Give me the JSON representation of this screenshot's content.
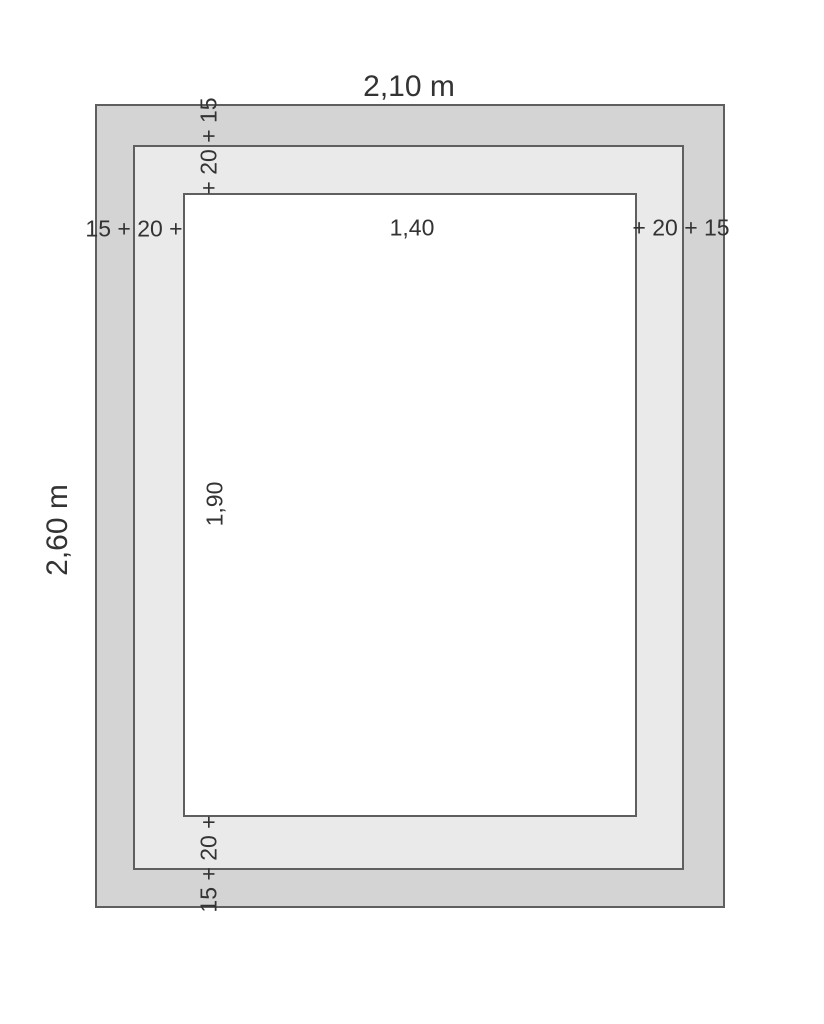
{
  "diagram": {
    "type": "nested-rectangle-dimension-drawing",
    "total_width_label": "2,10 m",
    "total_height_label": "2,60 m",
    "inner_width_label": "1,40",
    "inner_height_label": "1,90",
    "border_top_label": "+ 20 + 15",
    "border_left_label": "15 + 20 +",
    "border_right_label": "+ 20 + 15",
    "border_bottom_label": "15 + 20 +",
    "colors": {
      "outer_band": "#d4d4d4",
      "middle_band": "#eaeaea",
      "inner_panel": "#ffffff",
      "outline": "#5f5f5f",
      "text": "#333333",
      "page_background": "#ffffff"
    }
  }
}
